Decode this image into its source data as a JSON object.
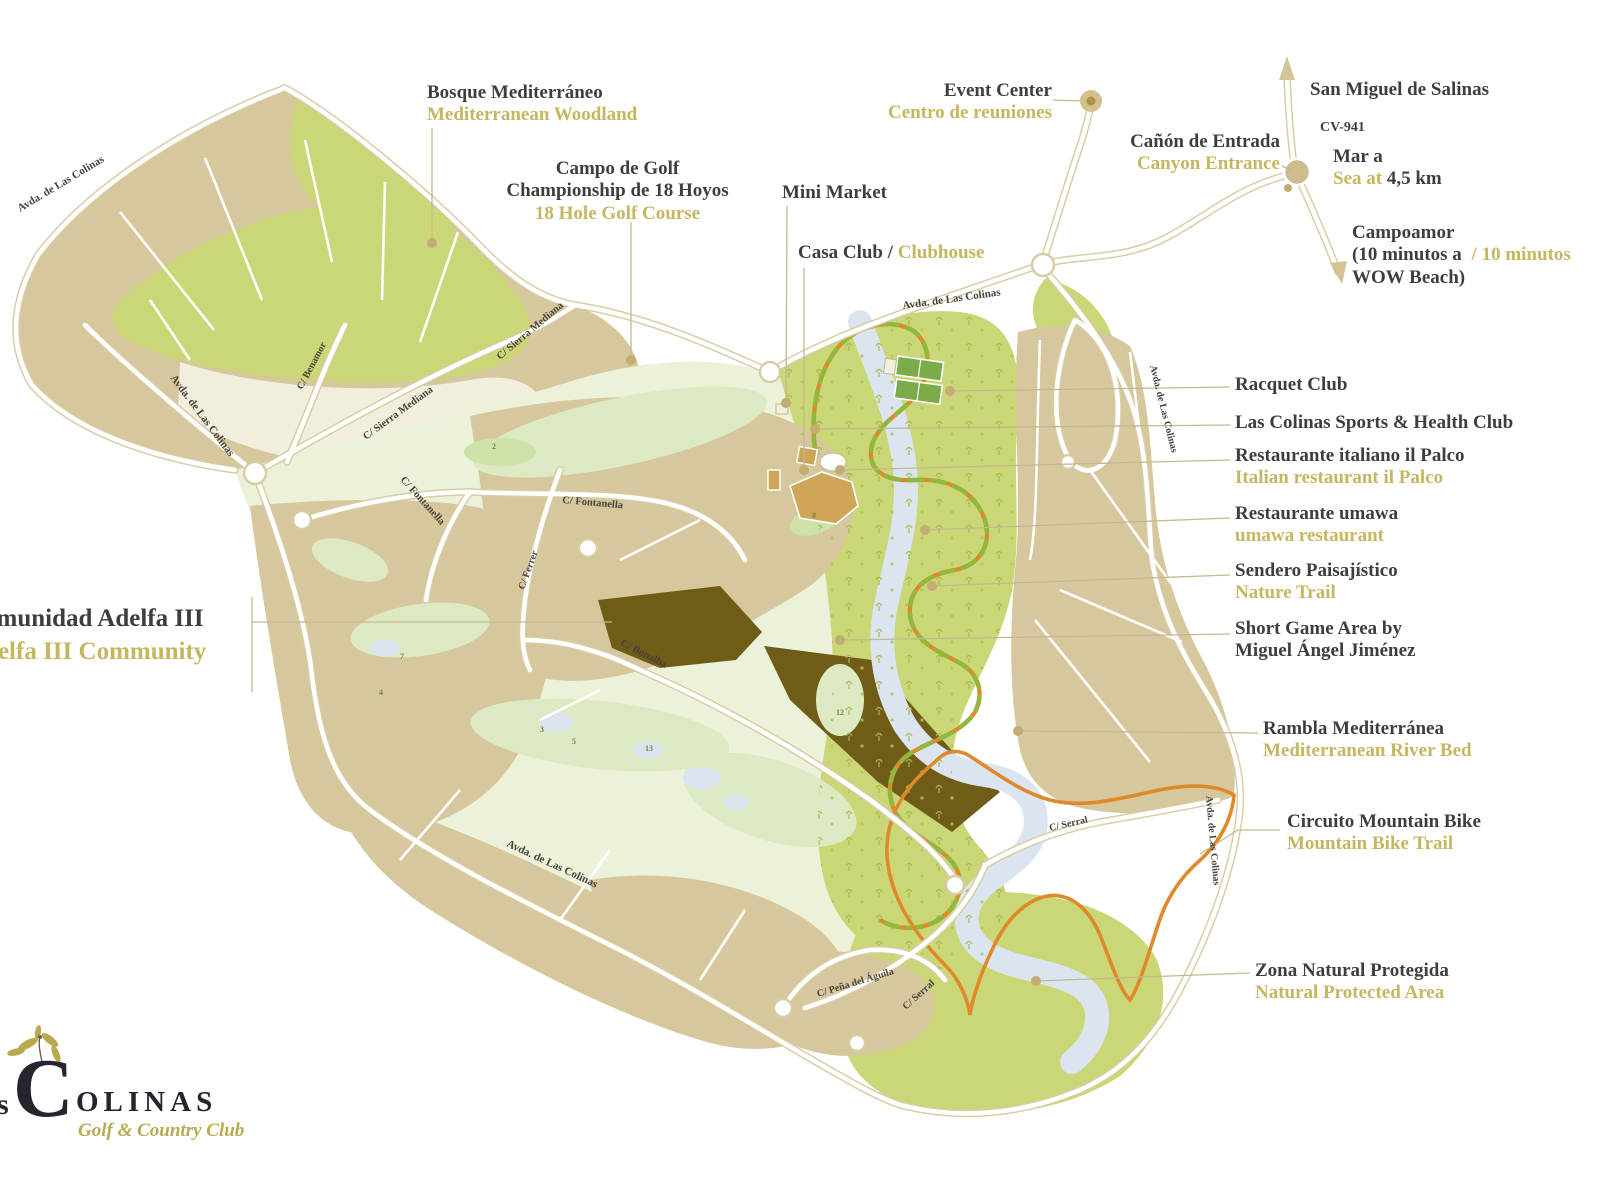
{
  "street_names": {
    "avda": "Avda. de Las Colinas",
    "sierra": "C/ Sierra Mediana",
    "benamor": "C/ Benamor",
    "fontanella": "C/ Fontanella",
    "ferrer": "C/ Ferrer",
    "bonalba": "C/ Bonalba",
    "pena": "C/ Peña del Águila",
    "serral": "C/ Serral"
  },
  "holes": [
    "7",
    "4",
    "2",
    "3",
    "5",
    "13",
    "12",
    "8"
  ],
  "annotations": {
    "bosque": {
      "title": "Bosque Mediterráneo",
      "subtitle": "Mediterranean Woodland"
    },
    "campo": {
      "title": "Campo de Golf",
      "line2": "Championship de 18 Hoyos",
      "subtitle": "18 Hole Golf Course"
    },
    "mini_market": {
      "title": "Mini Market"
    },
    "casa_club": {
      "title": "Casa Club /",
      "subtitle": "Clubhouse"
    },
    "event_center": {
      "title": "Event Center",
      "subtitle": "Centro de reuniones"
    },
    "canyon": {
      "title": "Cañón de Entrada",
      "subtitle": "Canyon Entrance"
    },
    "san_miguel": {
      "title": "San Miguel de Salinas"
    },
    "cv941": {
      "title": "CV-941"
    },
    "sea": {
      "line1": "Mar a",
      "gold": "Sea at",
      "dark": "4,5 km"
    },
    "campoamor": {
      "line1": "Campoamor",
      "line2_dark": "(10 minutos a",
      "line2_gold": "/ 10 minutos",
      "line3": "WOW Beach)"
    },
    "racquet": {
      "title": "Racquet Club"
    },
    "sports": {
      "title": "Las Colinas Sports & Health Club"
    },
    "palco": {
      "title": "Restaurante italiano il Palco",
      "subtitle": "Italian restaurant il Palco"
    },
    "umawa": {
      "title": "Restaurante umawa",
      "subtitle": "umawa restaurant"
    },
    "sendero": {
      "title": "Sendero Paisajístico",
      "subtitle": "Nature Trail"
    },
    "short_game": {
      "title": "Short Game Area by",
      "line2": "Miguel Ángel Jiménez"
    },
    "rambla": {
      "title": "Rambla Mediterránea",
      "subtitle": "Mediterranean River Bed"
    },
    "mtb": {
      "title": "Circuito Mountain Bike",
      "subtitle": "Mountain Bike Trail"
    },
    "zona": {
      "title": "Zona Natural Protegida",
      "subtitle": "Natural Protected Area"
    },
    "comunidad": {
      "title": "Comunidad Adelfa III",
      "subtitle": "Adelfa III Community"
    }
  },
  "logo": {
    "partial_s": "s",
    "initial": "C",
    "rest": "OLINAS",
    "tagline": "Golf & Country Club"
  },
  "colors": {
    "gold": "#c5b660",
    "dark_text": "#3f3e3a",
    "orange_trail": "#df8a2a",
    "trail_green": "#93b63c",
    "woodland_green": "#cbd677",
    "parcel_beige": "#d6c79c",
    "adelfa_dark": "#6f5c17",
    "river_blue": "#dbe5ef",
    "golf_pale": "#ecf1da",
    "road_casing": "#d8cca4",
    "leader": "#c5b78e"
  }
}
